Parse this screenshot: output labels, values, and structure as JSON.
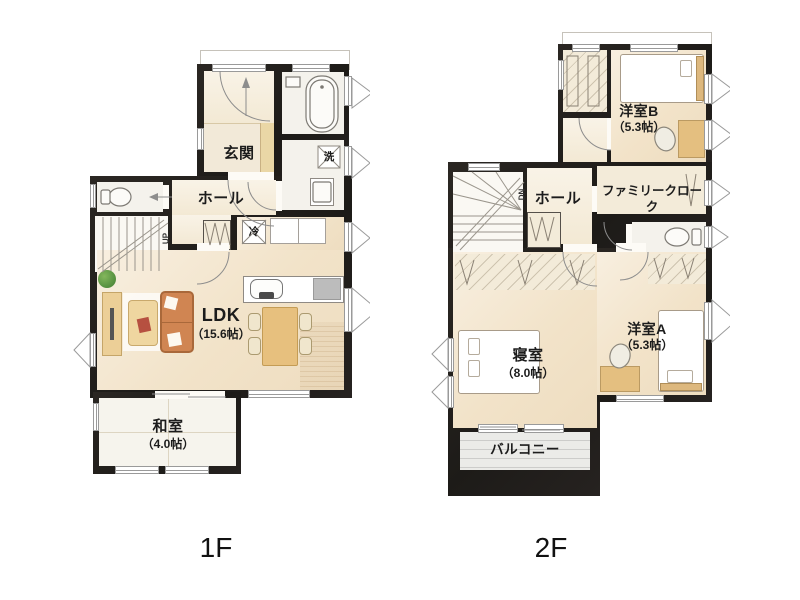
{
  "colors": {
    "wall": "#26231f",
    "floor_cream": "#f2e3c9",
    "tatami": "#f6f4ed",
    "balcony": "#ebebe8",
    "wood": "#e7c07e",
    "sofa": "#d08552",
    "plant_green": "#4e8f3a"
  },
  "f1": {
    "caption": "1F",
    "rooms": {
      "genkan": "玄関",
      "hall": "ホール",
      "ldk": "LDK",
      "ldk_size": "（15.6帖）",
      "washitsu": "和室",
      "washitsu_size": "（4.0帖）"
    },
    "symbols": {
      "laundry": "洗",
      "fridge": "冷",
      "stairs_up": "UP"
    }
  },
  "f2": {
    "caption": "2F",
    "rooms": {
      "yoshitsu_b": "洋室B",
      "yoshitsu_b_size": "（5.3帖）",
      "hall": "ホール",
      "family_cloak": "ファミリークローク",
      "shinshitsu": "寝室",
      "shinshitsu_size": "（8.0帖）",
      "yoshitsu_a": "洋室A",
      "yoshitsu_a_size": "（5.3帖）",
      "balcony": "バルコニー"
    },
    "symbols": {
      "stairs_down": "DN"
    }
  }
}
